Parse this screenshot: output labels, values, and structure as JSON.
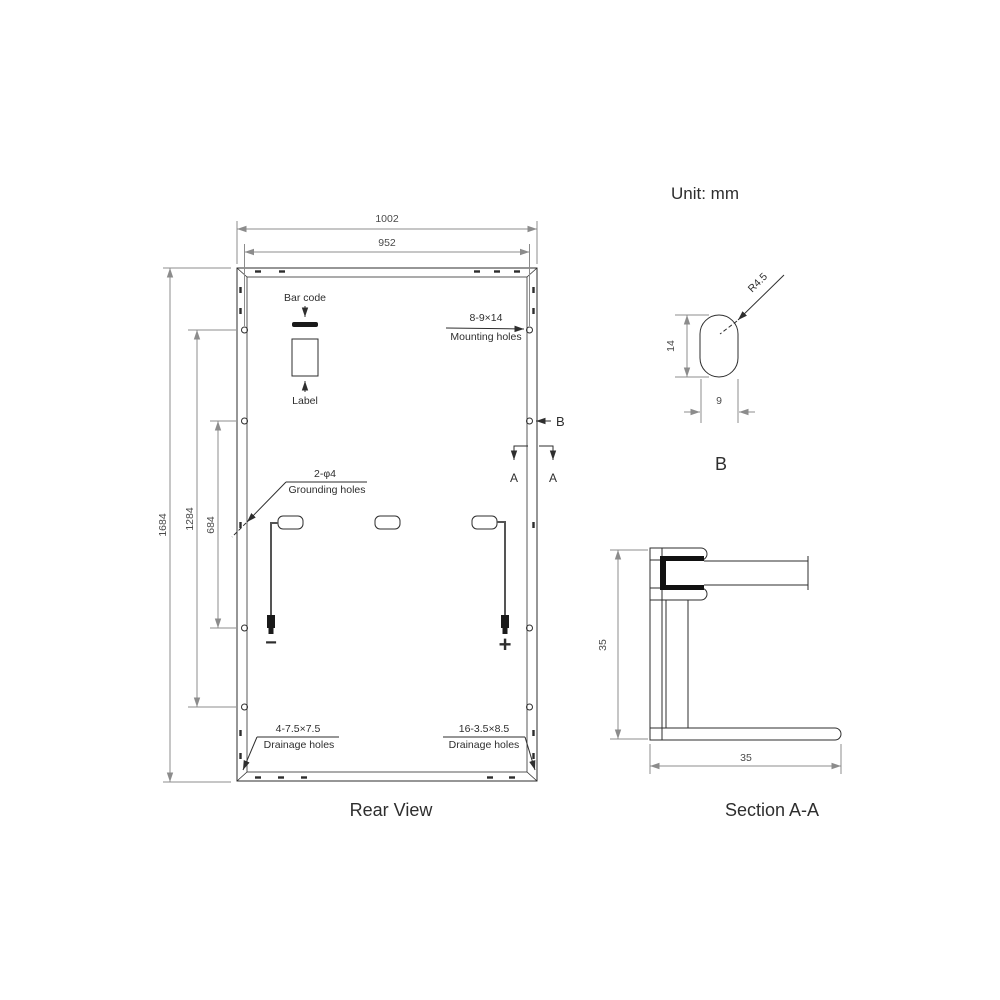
{
  "unit_label": "Unit: mm",
  "rear_view": {
    "title": "Rear View",
    "dims": {
      "overall_width": "1002",
      "mounting_width": "952",
      "overall_height": "1684",
      "mounting_span_outer": "1284",
      "mounting_span_inner": "684"
    },
    "annotations": {
      "bar_code": "Bar code",
      "label": "Label",
      "mounting_spec": "8-9×14",
      "mounting_name": "Mounting holes",
      "grounding_spec": "2-φ4",
      "grounding_name": "Grounding holes",
      "drainage_left_spec": "4-7.5×7.5",
      "drainage_left_name": "Drainage holes",
      "drainage_right_spec": "16-3.5×8.5",
      "drainage_right_name": "Drainage holes",
      "negative": "−",
      "positive": "+"
    },
    "markers": {
      "section_a": "A",
      "detail_b": "B"
    }
  },
  "detail_b": {
    "title": "B",
    "radius": "R4.5",
    "height": "14",
    "width": "9"
  },
  "section_aa": {
    "title": "Section A-A",
    "frame_height": "35",
    "frame_width": "35"
  },
  "colors": {
    "object_line": "#2e2e2e",
    "dim_line": "#8c8c8c",
    "hatch": "#6a6a6a",
    "background": "#ffffff"
  }
}
